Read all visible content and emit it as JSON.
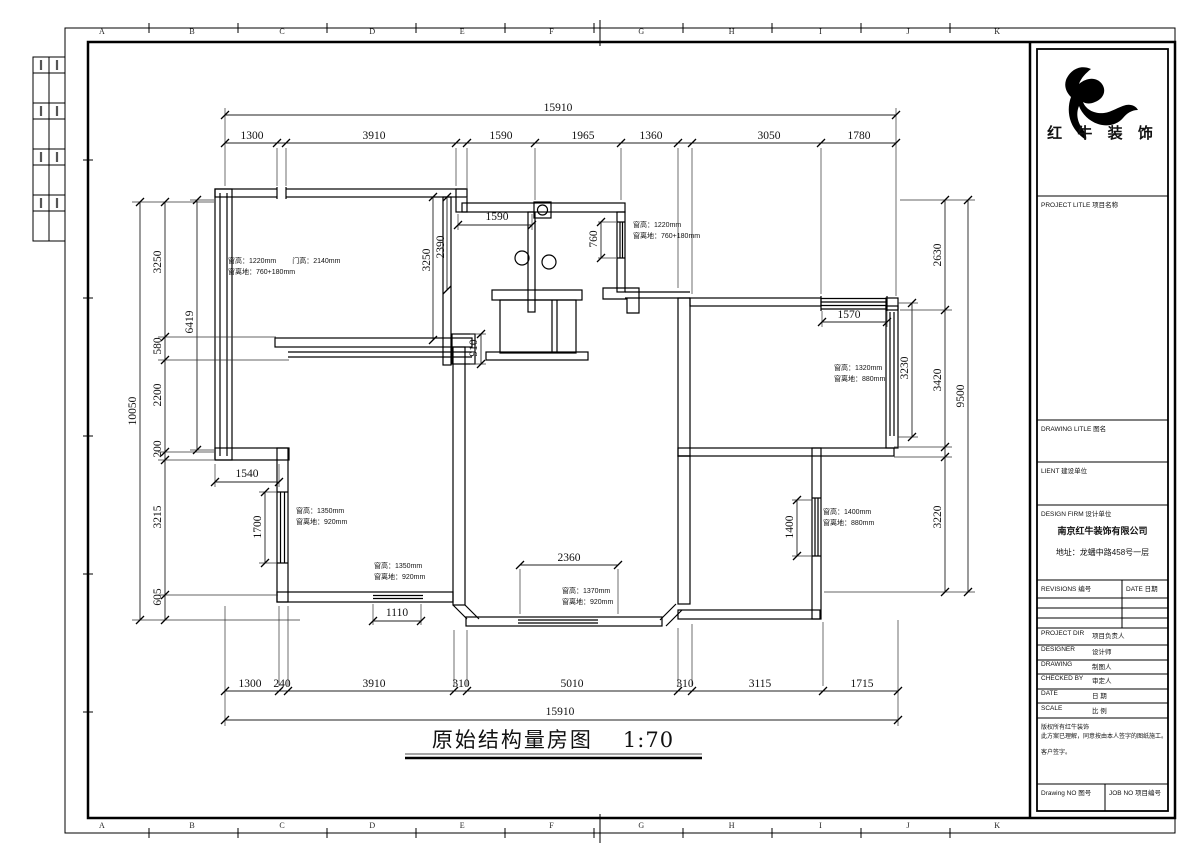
{
  "sheet": {
    "grid_letters": [
      "A",
      "B",
      "C",
      "D",
      "E",
      "F",
      "G",
      "H",
      "I",
      "J",
      "K"
    ],
    "title": "原始结构量房图",
    "title_scale": "1:70"
  },
  "dims": [
    "15910",
    "1300",
    "3910",
    "1590",
    "1965",
    "1360",
    "3050",
    "1780",
    "1300",
    "240",
    "3910",
    "310",
    "5010",
    "310",
    "3115",
    "1715",
    "15910",
    "3250",
    "580",
    "2200",
    "200",
    "3215",
    "605",
    "10050",
    "6419",
    "2630",
    "3420",
    "3220",
    "9500",
    "3230",
    "1570",
    "1400",
    "1590",
    "760",
    "910",
    "3250",
    "2390",
    "1540",
    "1700",
    "1110",
    "2360"
  ],
  "annotations": [
    {
      "l1": "窗高：1220mm",
      "l1b": "门高：2140mm",
      "l2": "窗离地：760+180mm"
    },
    {
      "l1": "窗高：1220mm",
      "l2": "窗离地：760+180mm"
    },
    {
      "l1": "窗高：1320mm",
      "l2": "窗离地：880mm"
    },
    {
      "l1": "窗高：1350mm",
      "l2": "窗离地：920mm"
    },
    {
      "l1": "窗高：1350mm",
      "l2": "窗离地：920mm"
    },
    {
      "l1": "窗高：1370mm",
      "l2": "窗离地：920mm"
    },
    {
      "l1": "窗高：1400mm",
      "l2": "窗离地：880mm"
    }
  ],
  "title_block": {
    "brand": "红 牛 装 饰",
    "project_title_label": "PROJECT LITLE  项目名称",
    "drawing_title_label": "DRAWING LITLE  图名",
    "client_label": "LIENT 建设单位",
    "design_firm_label": "DESIGN FIRM  设计单位",
    "company_name": "南京红牛装饰有限公司",
    "company_address": "地址：龙蟠中路458号一层",
    "revisions_label": "REVISIONS 编号",
    "date_col_label": "DATE 日期",
    "rows": [
      {
        "en": "PROJECT DIR",
        "cn": "项目负责人"
      },
      {
        "en": "DESIGNER",
        "cn": "设计师"
      },
      {
        "en": "DRAWING",
        "cn": "制图人"
      },
      {
        "en": "CHECKED BY",
        "cn": "审定人"
      },
      {
        "en": "DATE",
        "cn": "日  期"
      },
      {
        "en": "SCALE",
        "cn": "比  例"
      }
    ],
    "notes": [
      "版权所有红牛装饰",
      "此方案已理解，同意按由本人签字的图纸施工。",
      "客户签字。"
    ],
    "drawing_no_label": "Drawing NO  图号",
    "job_no_label": "JOB NO  项目编号"
  }
}
